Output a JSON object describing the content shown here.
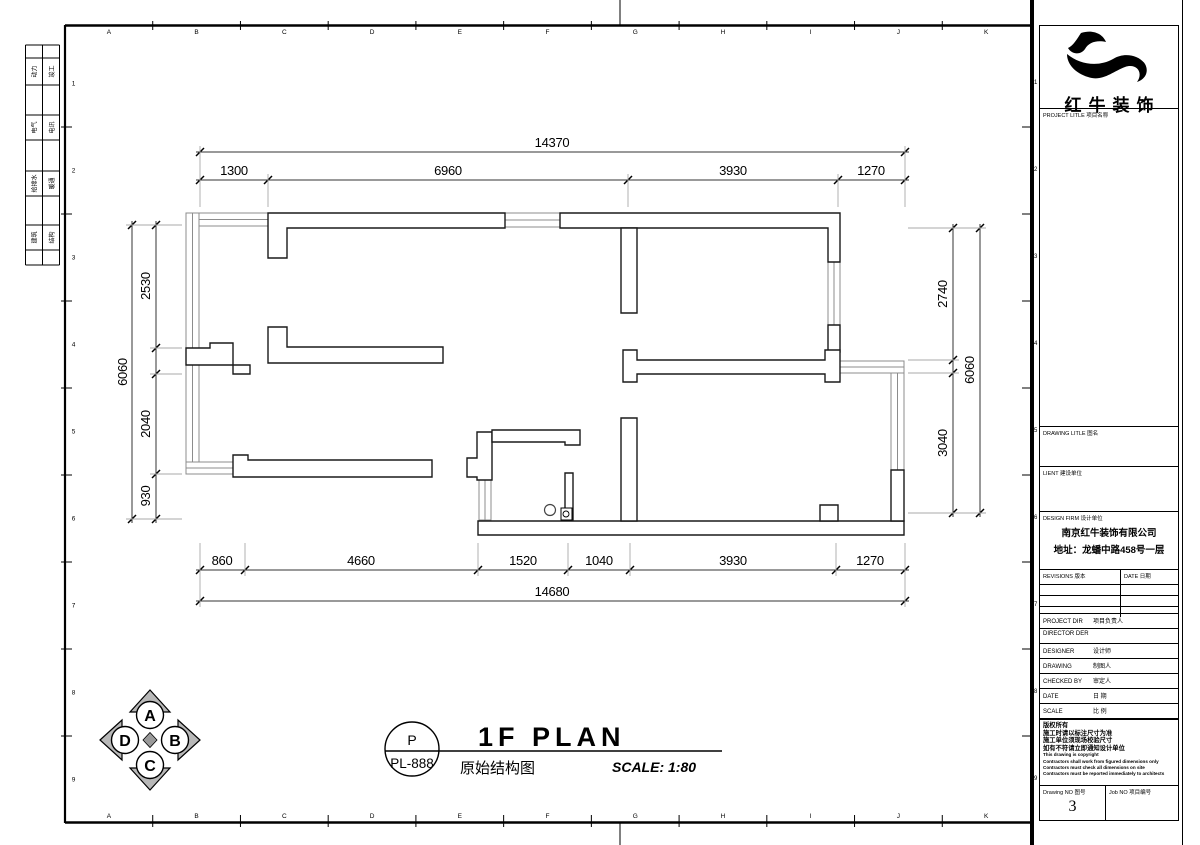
{
  "colors": {
    "paper": "#ffffff",
    "line": "#000000",
    "window_line": "#8c8c8c",
    "compass_fill": "#b8b8b8"
  },
  "frame": {
    "grid_letters": [
      "A",
      "B",
      "C",
      "D",
      "E",
      "F",
      "G",
      "H",
      "I",
      "J",
      "K"
    ],
    "grid_numbers": [
      "1",
      "2",
      "3",
      "4",
      "5",
      "6",
      "7",
      "8",
      "9"
    ],
    "disciplines": [
      [
        "动力",
        "竣工"
      ],
      [
        "电气",
        "电讯"
      ],
      [
        "给排水",
        "暖通"
      ],
      [
        "建筑",
        "结构"
      ]
    ]
  },
  "plan": {
    "dims": {
      "top_overall": "14370",
      "top": [
        "1300",
        "6960",
        "3930",
        "1270"
      ],
      "bottom": [
        "860",
        "4660",
        "1520",
        "1040",
        "3930",
        "1270"
      ],
      "bottom_overall": "14680",
      "left_overall": "6060",
      "left": [
        "2530",
        "2040",
        "930"
      ],
      "right": [
        "2740",
        "3040"
      ],
      "right_overall": "6060"
    }
  },
  "title_area": {
    "stamp_top": "P",
    "stamp_bottom": "PL-888",
    "title_en": "1F PLAN",
    "title_cn": "原始结构图",
    "scale": "SCALE: 1:80"
  },
  "compass": {
    "a": "A",
    "b": "B",
    "c": "C",
    "d": "D"
  },
  "titleblock": {
    "company": "红牛装饰",
    "project_title_label": "PROJECT LITLE  项目名称",
    "drawing_title_label": "DRAWING LITLE  图名",
    "client_label": "LIENT  建设单位",
    "design_firm_label": "DESIGN FIRM  设计单位",
    "design_firm_name": "南京红牛装饰有限公司",
    "design_firm_addr": "地址：龙蟠中路458号一层",
    "revisions_label": "REVISIONS  版本",
    "date_col_label": "DATE  日期",
    "rows": [
      {
        "en": "PROJECT DIR",
        "cn": "项目负责人"
      },
      {
        "en": "DIRECTOR DER",
        "cn": ""
      },
      {
        "en": "DESIGNER",
        "cn": "设计师"
      },
      {
        "en": "DRAWING",
        "cn": "制图人"
      },
      {
        "en": "CHECKED BY",
        "cn": "审定人"
      },
      {
        "en": "DATE",
        "cn": "日  期"
      },
      {
        "en": "SCALE",
        "cn": "比  例"
      }
    ],
    "notes": [
      "版权所有",
      "施工时请以标注尺寸为准",
      "施工单位须现场校验尺寸",
      "如有不符请立即通知设计单位",
      "This drawing is copyright",
      "Contractors shall work from figured dimensions only",
      "Contractors must check all dimensions on site",
      "Contractors must be reported immediately to architects"
    ],
    "drawing_no_label": "Drawing NO  图号",
    "drawing_no": "3",
    "job_no_label": "Job NO  项目编号"
  }
}
